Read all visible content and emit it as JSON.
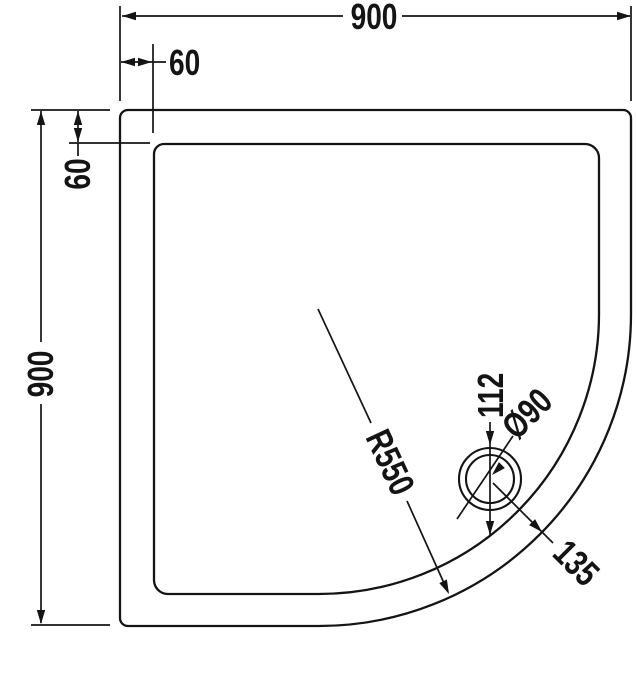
{
  "drawing": {
    "view": "shower-tray-plan",
    "colors": {
      "line": "#141414",
      "background": "#ffffff"
    },
    "dimensions": {
      "overall_width": "900",
      "overall_height": "900",
      "edge_inset_top": "60",
      "edge_inset_left": "60",
      "drain_offset": "112",
      "drain_diameter": "Ø90",
      "front_radius": "R550",
      "drain_edge_distance": "135"
    }
  }
}
